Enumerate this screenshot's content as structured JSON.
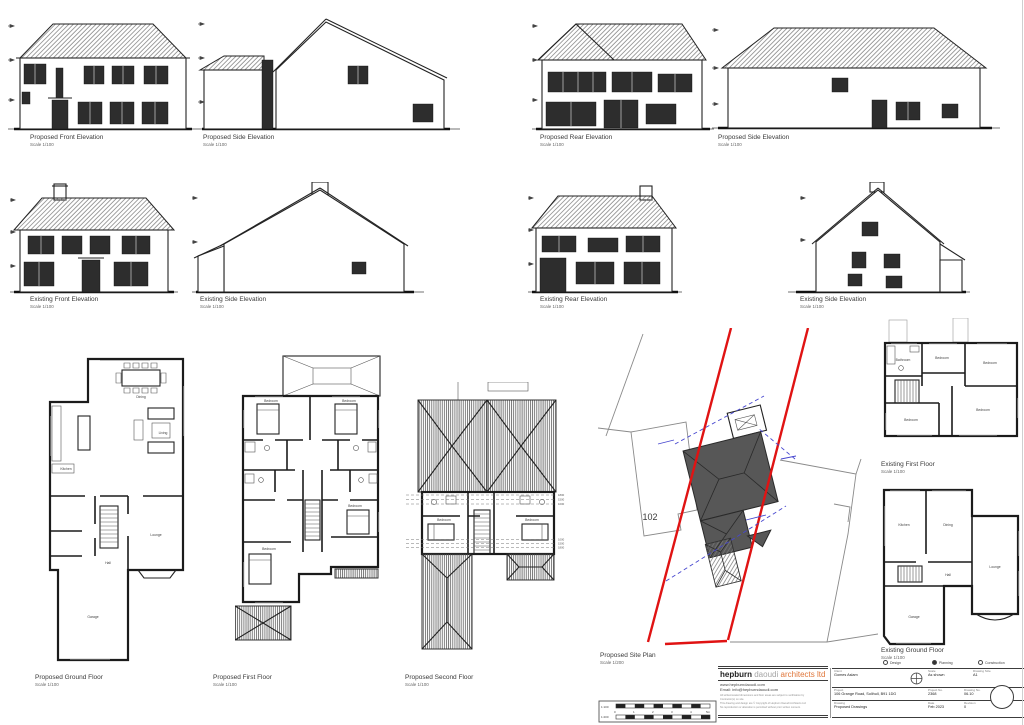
{
  "labels": {
    "row1": [
      {
        "title": "Proposed Front Elevation",
        "scale": "Scale 1/100"
      },
      {
        "title": "Proposed Side Elevation",
        "scale": "Scale 1/100"
      },
      {
        "title": "Proposed Rear Elevation",
        "scale": "Scale 1/100"
      },
      {
        "title": "Proposed Side Elevation",
        "scale": "Scale 1/100"
      }
    ],
    "row2": [
      {
        "title": "Existing Front Elevation",
        "scale": "Scale 1/100"
      },
      {
        "title": "Existing Side Elevation",
        "scale": "Scale 1/100"
      },
      {
        "title": "Existing Rear Elevation",
        "scale": "Scale 1/100"
      },
      {
        "title": "Existing Side Elevation",
        "scale": "Scale 1/100"
      }
    ],
    "plans": [
      {
        "title": "Proposed Ground Floor",
        "scale": "Scale 1/100"
      },
      {
        "title": "Proposed First Floor",
        "scale": "Scale 1/100"
      },
      {
        "title": "Proposed Second Floor",
        "scale": "Scale 1/100"
      },
      {
        "title": "Proposed Site Plan",
        "scale": "Scale 1/200"
      },
      {
        "title": "Existing First Floor",
        "scale": "Scale 1/100"
      },
      {
        "title": "Existing Ground Floor",
        "scale": "Scale 1/100"
      }
    ]
  },
  "site": {
    "neighbor_number": "102"
  },
  "rooms": {
    "existing_first": {
      "r1": "Bathroom",
      "r2": "Bedroom",
      "r3": "Bedroom",
      "r4": "Bedroom",
      "r5": "Bedroom"
    },
    "existing_ground": {
      "r1": "Kitchen",
      "r2": "Dining",
      "r3": "Lounge",
      "r4": "Hall",
      "r5": "Garage"
    },
    "proposed_ground": {
      "r1": "Dining",
      "r2": "Kitchen",
      "r3": "Living",
      "r4": "Hall",
      "r5": "Lounge",
      "r6": "Garage"
    },
    "proposed_first": {
      "r1": "Bedroom",
      "r2": "Bedroom",
      "r3": "Bedroom",
      "r4": "Bedroom"
    },
    "proposed_second": {
      "r1": "Bedroom",
      "r2": "Bedroom"
    }
  },
  "second_floor_dims": {
    "d1": "1800",
    "d2": "1500",
    "d3": "1000"
  },
  "title_block": {
    "firm": {
      "name_bold": "hepburn",
      "name_mid": "daoudi",
      "name_accent": "architects ltd",
      "website": "www.hepburndaoudi.com",
      "email": "Email: info@hepburndaoudi.com",
      "disclaimer1": "All written/scaled dimensions and floor areas are subject to verification by",
      "disclaimer2": "Contractor(s) on site.",
      "disclaimer3": "This drawing and design are © Copyright of Hepburn Daoudi Architects Ltd",
      "disclaimer4": "No reproduction or alteration is permitted without prior written consent."
    },
    "status": {
      "design": "Design",
      "planning": "Planning",
      "construction": "Construction"
    },
    "fields": {
      "client_label": "Client",
      "client": "Gomes Aslam",
      "scale_label": "Scale",
      "scale": "As shown",
      "size_label": "Drawing Size",
      "size": "A1",
      "project_label": "Project",
      "project": "106 Grange Road, Solihull, B91 1DG",
      "project_no_label": "Project No.",
      "project_no": "2368",
      "drawing_no_label": "Drawing No.",
      "drawing_no": "06.10",
      "drawing_label": "Drawing",
      "drawing": "Proposed Drawings",
      "date_label": "Date",
      "date": "Feb 2023",
      "revision_label": "Revision",
      "revision": "0"
    }
  },
  "scale_bar": {
    "left_top": "1:100",
    "left_bottom": "1:200",
    "ticks": [
      "0",
      "1",
      "2",
      "3",
      "4",
      "5m"
    ]
  }
}
